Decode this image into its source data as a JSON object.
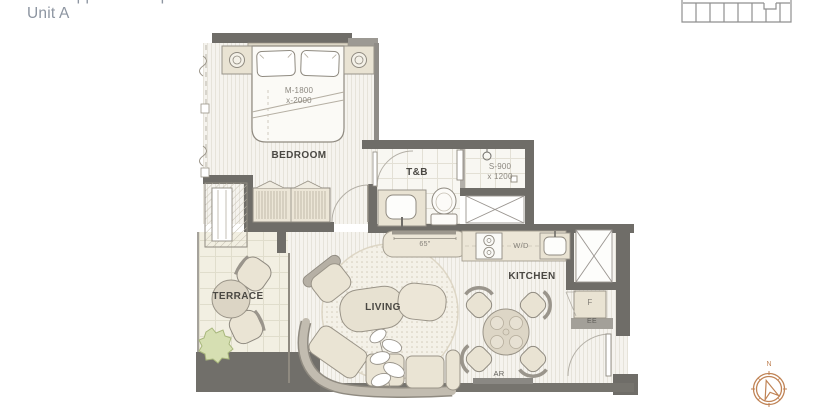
{
  "header": {
    "size_label": "Size: Approx. 54 sqm",
    "unit_label": "Unit A"
  },
  "rooms": {
    "bedroom": {
      "label": "BEDROOM",
      "bed_dim_line1": "M-1800",
      "bed_dim_line2": "x-2000"
    },
    "bathroom": {
      "label": "T&B",
      "shower_dim_line1": "S-900",
      "shower_dim_line2": "x 1200"
    },
    "terrace": {
      "label": "TERRACE"
    },
    "living": {
      "label": "LIVING"
    },
    "kitchen": {
      "label": "KITCHEN",
      "washer_dryer_label": "W/D"
    }
  },
  "annotations": {
    "tv_size": "65\"",
    "fridge_label": "F",
    "electrical_label": "EE",
    "ac_return_label": "AR"
  },
  "compass": {
    "north_label": "N"
  },
  "colors": {
    "wall": "#6f6d68",
    "wall_light": "#9c9993",
    "compass_accent": "#c08355",
    "furniture_fill": "#eae4d4",
    "label_text": "#4a4843",
    "header_text": "#8d95a1"
  }
}
